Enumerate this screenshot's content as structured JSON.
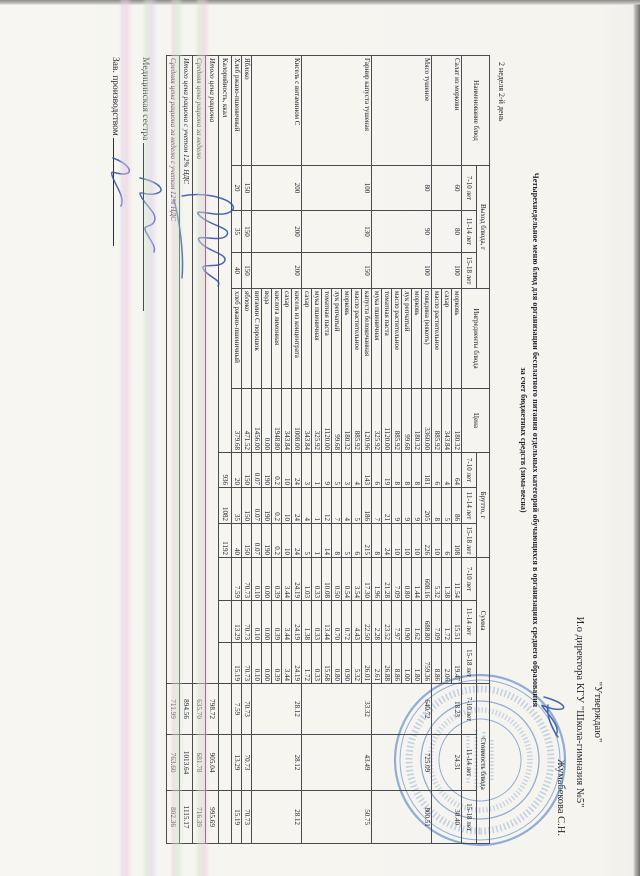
{
  "colors": {
    "ink": "#26262e",
    "stamp_blue": "#6d92cc",
    "signature_blue": "#2e4da6",
    "paper": "#f5f4ef"
  },
  "page": {
    "week_day": "2 неделя 2-й день",
    "title_line1": "Четырехнедельное меню блюд для организации бесплатного питания отдельных категорий обучающихся в организациях среднего образования",
    "title_line2": "за счет бюджетных средств (зима-весна)",
    "approve": {
      "line1": "\"Утверждаю\"",
      "line2": "И.о директора КГУ \"Школа-гимназия №5\"",
      "line3": "Жумабекова С.Н."
    },
    "signatures": [
      {
        "label": "Медицинская сестра"
      },
      {
        "label": "Зав. производством"
      }
    ]
  },
  "table": {
    "headers": {
      "name": "Наименование блюд",
      "output": "Выход блюда, г",
      "ingredients": "Ингредиенты блюда",
      "price": "Цена",
      "brutto": "Брутто, г",
      "sum": "Сумма",
      "cost": "Стоимость блюда"
    },
    "age_groups": [
      "7-10 лет",
      "11-14 лет",
      "15-18 лет"
    ],
    "dishes": [
      {
        "name": "Салат из моркови",
        "out": [
          "60",
          "80",
          "100"
        ],
        "cost": [
          "18.23",
          "24.31",
          "30.40"
        ],
        "rows": [
          {
            "n": "морковь",
            "p": "180.32",
            "b": [
              "64",
              "86",
              "108"
            ],
            "s": [
              "11.54",
              "15.51",
              "19.47"
            ]
          },
          {
            "n": "сахар",
            "p": "343.84",
            "b": [
              "4",
              "5",
              "6"
            ],
            "s": [
              "1.38",
              "1.72",
              "2.06"
            ]
          },
          {
            "n": "масло растительное",
            "p": "885.92",
            "b": [
              "6",
              "8",
              "10"
            ],
            "s": [
              "5.32",
              "7.09",
              "8.86"
            ]
          }
        ]
      },
      {
        "name": "Мясо тушеное",
        "out": [
          "80",
          "90",
          "100"
        ],
        "cost": [
          "640.72",
          "725.09",
          "800.51"
        ],
        "rows": [
          {
            "n": "говядина (мякоть)",
            "p": "3360.00",
            "b": [
              "181",
              "205",
              "226"
            ],
            "s": [
              "608.16",
              "688.80",
              "759.36"
            ]
          },
          {
            "n": "морковь",
            "p": "180.32",
            "b": [
              "8",
              "9",
              "10"
            ],
            "s": [
              "1.44",
              "1.62",
              "1.80"
            ]
          },
          {
            "n": "лук репчатый",
            "p": "99.68",
            "b": [
              "8",
              "9",
              "10"
            ],
            "s": [
              "0.80",
              "0.90",
              "1.00"
            ]
          },
          {
            "n": "масло растительное",
            "p": "885.92",
            "b": [
              "8",
              "9",
              "10"
            ],
            "s": [
              "7.09",
              "7.97",
              "8.86"
            ]
          },
          {
            "n": "томатная паста",
            "p": "1120.00",
            "b": [
              "19",
              "21",
              "24"
            ],
            "s": [
              "21.28",
              "23.52",
              "26.88"
            ]
          },
          {
            "n": "мука пшеничная",
            "p": "325.92",
            "b": [
              "6",
              "7",
              "8"
            ],
            "s": [
              "1.96",
              "2.28",
              "2.61"
            ]
          }
        ]
      },
      {
        "name": "Гарнир капуста тушеная",
        "out": [
          "100",
          "130",
          "150"
        ],
        "cost": [
          "33.32",
          "43.49",
          "50.75"
        ],
        "rows": [
          {
            "n": "капуста белокочанная",
            "p": "120.96",
            "b": [
              "143",
              "186",
              "215"
            ],
            "s": [
              "17.30",
              "22.50",
              "26.01"
            ]
          },
          {
            "n": "масло растительное",
            "p": "885.92",
            "b": [
              "4",
              "5",
              "6"
            ],
            "s": [
              "3.54",
              "4.43",
              "5.32"
            ]
          },
          {
            "n": "морковь",
            "p": "180.32",
            "b": [
              "3",
              "4",
              "5"
            ],
            "s": [
              "0.54",
              "0.72",
              "0.90"
            ]
          },
          {
            "n": "лук репчатый",
            "p": "99.68",
            "b": [
              "5",
              "7",
              "8"
            ],
            "s": [
              "0.50",
              "0.70",
              "0.80"
            ]
          },
          {
            "n": "томатная паста",
            "p": "1120.00",
            "b": [
              "9",
              "12",
              "14"
            ],
            "s": [
              "10.08",
              "13.44",
              "15.68"
            ]
          },
          {
            "n": "мука пшеничная",
            "p": "325.92",
            "b": [
              "1",
              "1",
              "1"
            ],
            "s": [
              "0.33",
              "0.33",
              "0.33"
            ]
          },
          {
            "n": "сахар",
            "p": "343.84",
            "b": [
              "3",
              "4",
              "5"
            ],
            "s": [
              "1.03",
              "1.38",
              "1.72"
            ]
          }
        ]
      },
      {
        "name": "Кисель с витамином С",
        "out": [
          "200",
          "200",
          "200"
        ],
        "cost": [
          "28.12",
          "28.12",
          "28.12"
        ],
        "rows": [
          {
            "n": "кисель из концентрата",
            "p": "1008.00",
            "b": [
              "24",
              "24",
              "24"
            ],
            "s": [
              "24.19",
              "24.19",
              "24.19"
            ]
          },
          {
            "n": "сахар",
            "p": "343.84",
            "b": [
              "10",
              "10",
              "10"
            ],
            "s": [
              "3.44",
              "3.44",
              "3.44"
            ]
          },
          {
            "n": "кислота лимонная",
            "p": "1948.80",
            "b": [
              "0.2",
              "0.2",
              "0.2"
            ],
            "s": [
              "0.39",
              "0.39",
              "0.39"
            ]
          },
          {
            "n": "вода",
            "p": "0.00",
            "b": [
              "190",
              "190",
              "190"
            ],
            "s": [
              "0.00",
              "0.00",
              "0.00"
            ]
          },
          {
            "n": "витамин С порошок",
            "p": "1456.00",
            "b": [
              "0.07",
              "0.07",
              "0.07"
            ],
            "s": [
              "0.10",
              "0.10",
              "0.10"
            ]
          }
        ]
      },
      {
        "name": "Яблоко",
        "out": [
          "150",
          "150",
          "150"
        ],
        "cost": [
          "70.73",
          "70.73",
          "70.73"
        ],
        "rows": [
          {
            "n": "яблоко",
            "p": "471.52",
            "b": [
              "150",
              "150",
              "150"
            ],
            "s": [
              "70.73",
              "70.73",
              "70.73"
            ]
          }
        ]
      },
      {
        "name": "Хлеб ржано-пшеничный",
        "out": [
          "20",
          "35",
          "40"
        ],
        "cost": [
          "7.59",
          "13.29",
          "15.19"
        ],
        "rows": [
          {
            "n": "хлеб ржано-пшеничный",
            "p": "379.68",
            "b": [
              "20",
              "35",
              "40"
            ],
            "s": [
              "7.59",
              "13.29",
              "15.19"
            ]
          }
        ]
      }
    ],
    "calories": {
      "label": "Калорийность, ккал",
      "values": [
        "936",
        "1082",
        "1192"
      ]
    },
    "footers": [
      {
        "label": "Итого цена рациона",
        "values": [
          "798.72",
          "905.04",
          "995.69"
        ]
      },
      {
        "label": "Средняя цена рациона за неделю",
        "values": [
          "635.70",
          "681.78",
          "716.39"
        ]
      },
      {
        "label": "Итого цена рациона с учетом 12% НДС",
        "values": [
          "894.56",
          "1013.64",
          "1115.17"
        ]
      },
      {
        "label": "Средняя цена рациона за неделю с учетом 12% НДС",
        "values": [
          "711.99",
          "763.60",
          "802.36"
        ]
      }
    ]
  }
}
